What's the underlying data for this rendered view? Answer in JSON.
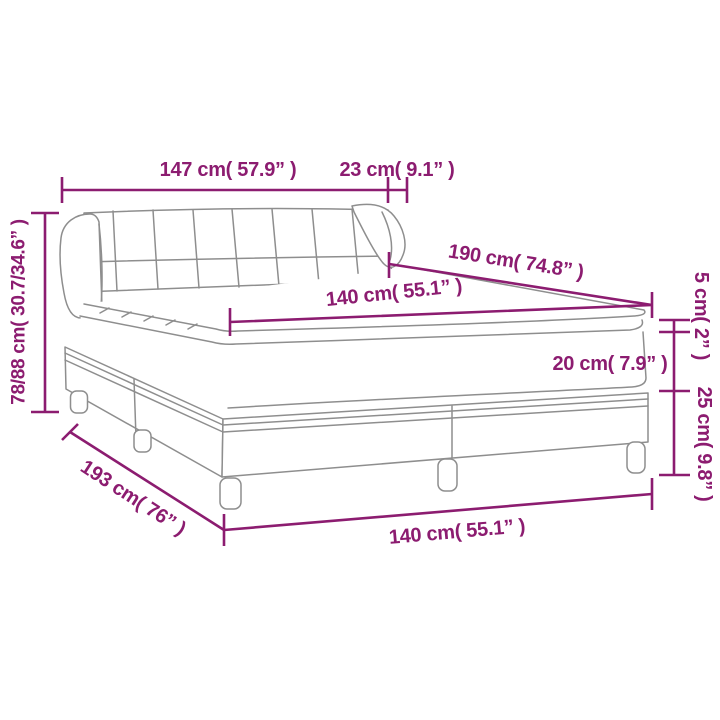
{
  "diagram": {
    "description": "Box spring bed with tufted headboard and topper – product dimension line drawing",
    "background_color": "#FFFFFF",
    "artwork_color": "#8E8E8E",
    "dimension_color": "#8C1C70",
    "measurements": {
      "headboard_width": "147 cm( 57.9” )",
      "headboard_wing": "23 cm( 9.1” )",
      "overall_height": "78/88 cm( 30.7/34.6” )",
      "bed_top_length": "190 cm( 74.8” )",
      "mattress_width": "140 cm( 55.1” )",
      "topper_height": "5 cm( 2” )",
      "mattress_height": "20 cm( 7.9” )",
      "base_leg_height": "25 cm( 9.8” )",
      "bed_base_length": "193 cm( 76” )",
      "bed_base_width": "140 cm( 55.1” )"
    }
  }
}
